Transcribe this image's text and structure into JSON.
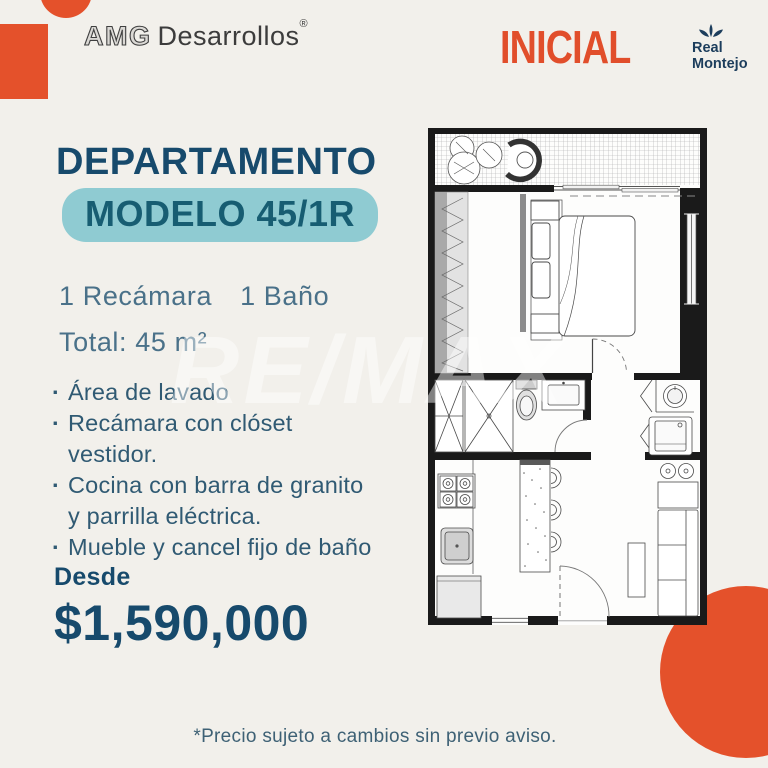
{
  "page": {
    "background": "#F2F0EB",
    "accent_orange": "#E4512B",
    "navy": "#174A6C",
    "teal_badge_bg": "#8FCBD2",
    "teal_badge_text": "#175D72"
  },
  "header": {
    "brand_left": {
      "name_outline": "AMG",
      "name_solid": "Desarrollos",
      "registered_mark": "®"
    },
    "brand_right": {
      "title": "INICIAL",
      "subtitle_line1": "Real",
      "subtitle_line2": "Montejo"
    }
  },
  "listing": {
    "title": "DEPARTAMENTO",
    "model_badge": "MODELO 45/1R",
    "bedrooms": "1 Recámara",
    "bathrooms": "1 Baño",
    "total_area": "Total: 45 m²",
    "features": [
      {
        "line1": "Área de lavado",
        "line2": ""
      },
      {
        "line1": "Recámara con clóset",
        "line2": "vestidor."
      },
      {
        "line1": "Cocina con barra de granito",
        "line2": "y parrilla eléctrica."
      },
      {
        "line1": "Mueble y cancel fijo de baño",
        "line2": ""
      }
    ],
    "price_label": "Desde",
    "price": "$1,590,000"
  },
  "floor_plan": {
    "description": "Architectural top-view plan of apartment model 45/1R",
    "rooms": [
      "terraza",
      "recámara",
      "baño",
      "área de lavado",
      "cocina",
      "sala-comedor"
    ],
    "fixtures": [
      "plants",
      "hanging-chair",
      "closet-vestidor",
      "double-bed",
      "nightstands",
      "shower",
      "toilet",
      "bathroom-vanity",
      "laundry-sink",
      "washer",
      "stove",
      "kitchen-sink",
      "refrigerator",
      "granite-island",
      "bar-stools",
      "round-stools",
      "console",
      "coffee-table",
      "sofa"
    ]
  },
  "watermark": "RE/MAX",
  "footer": {
    "disclaimer": "*Precio sujeto a cambios sin previo aviso."
  }
}
